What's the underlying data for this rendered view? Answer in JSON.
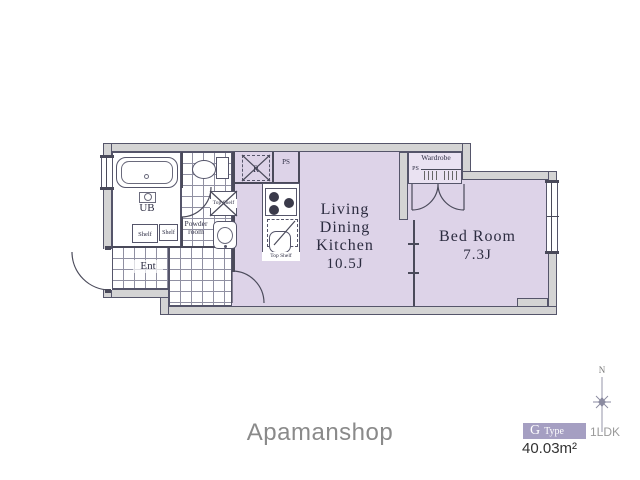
{
  "colors": {
    "floor": "#ddd3e8",
    "wall_fill": "#d4d4d4",
    "plan_line": "#4a4a5a",
    "badge_bg": "#a59fc2",
    "brand_gray": "#8a8a8a"
  },
  "rooms": {
    "ldk": {
      "label_lines": [
        "Living",
        "Dining",
        "Kitchen"
      ],
      "size": "10.5J"
    },
    "bedroom": {
      "label": "Bed Room",
      "size": "7.3J"
    },
    "unit_bath": {
      "label": "UB"
    },
    "powder_room": {
      "label_line1": "Powder",
      "label_line2": "room"
    },
    "entrance": {
      "label": "Ent"
    },
    "wardrobe": {
      "label": "Wardrobe",
      "ps_label": "PS"
    }
  },
  "fixtures": {
    "shelf_left": "Shelf",
    "shelf_right": "Shelf",
    "laundry_top_shelf": "Top Shelf",
    "kitchen_top_shelf": "Top Shelf",
    "refrigerator": "R",
    "pipe_space": "PS"
  },
  "compass": {
    "north_label": "N"
  },
  "brand": {
    "name": "Apamanshop"
  },
  "unit_info": {
    "type_letter": "G",
    "type_word": "Type",
    "layout": "1LDK",
    "area": "40.03m²"
  }
}
